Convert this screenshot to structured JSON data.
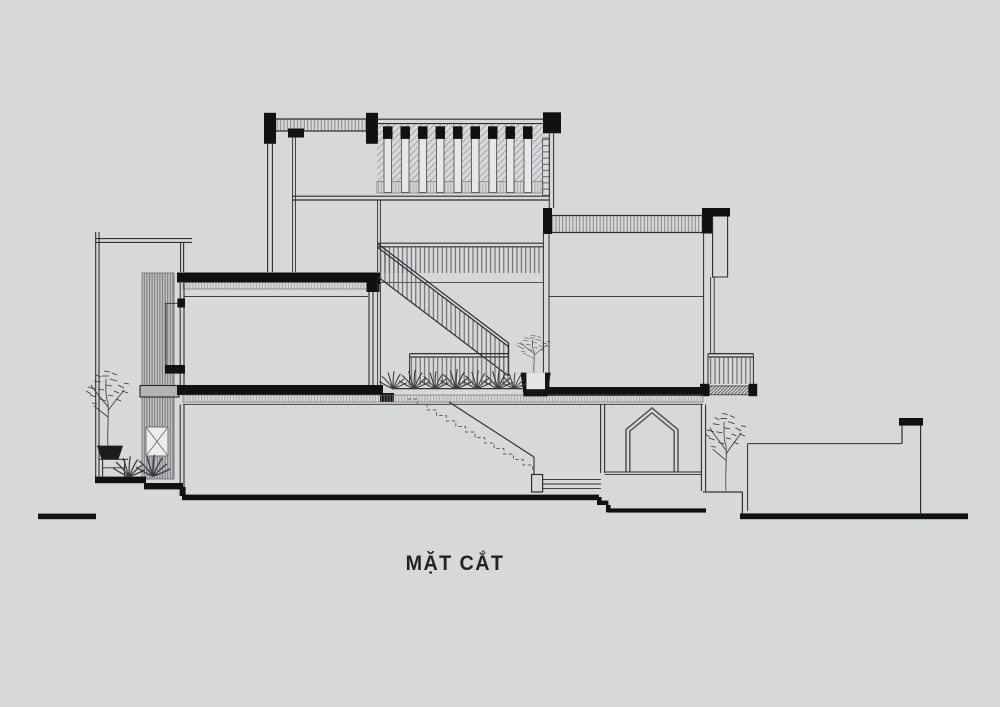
{
  "title": {
    "label": "MẶT CẮT"
  },
  "sheet": {
    "background": "#d7d8da",
    "ink": "#2e2e32",
    "cut_fill": "#111113",
    "hatch_gray": "#8a8a8e",
    "screen_gray": "#7a7a7e",
    "pentagon_gray": "#55555a"
  },
  "drawing": {
    "type": "architectural-section",
    "floors": [
      "ground-floor",
      "second-floor",
      "roof-terrace"
    ],
    "elements": [
      {
        "name": "roof-slab"
      },
      {
        "name": "roof-louver-wall"
      },
      {
        "name": "right-wing-roof"
      },
      {
        "name": "stair-with-railing"
      },
      {
        "name": "landing-guardrail"
      },
      {
        "name": "hidden-stair-dashed"
      },
      {
        "name": "balcony-with-railing"
      },
      {
        "name": "facade-screen"
      },
      {
        "name": "entry-frame"
      },
      {
        "name": "window-recess"
      },
      {
        "name": "house-shaped-niche"
      },
      {
        "name": "planter-with-plants"
      },
      {
        "name": "potted-trees"
      },
      {
        "name": "stepped-ground-line"
      },
      {
        "name": "boundary-wall"
      }
    ]
  }
}
